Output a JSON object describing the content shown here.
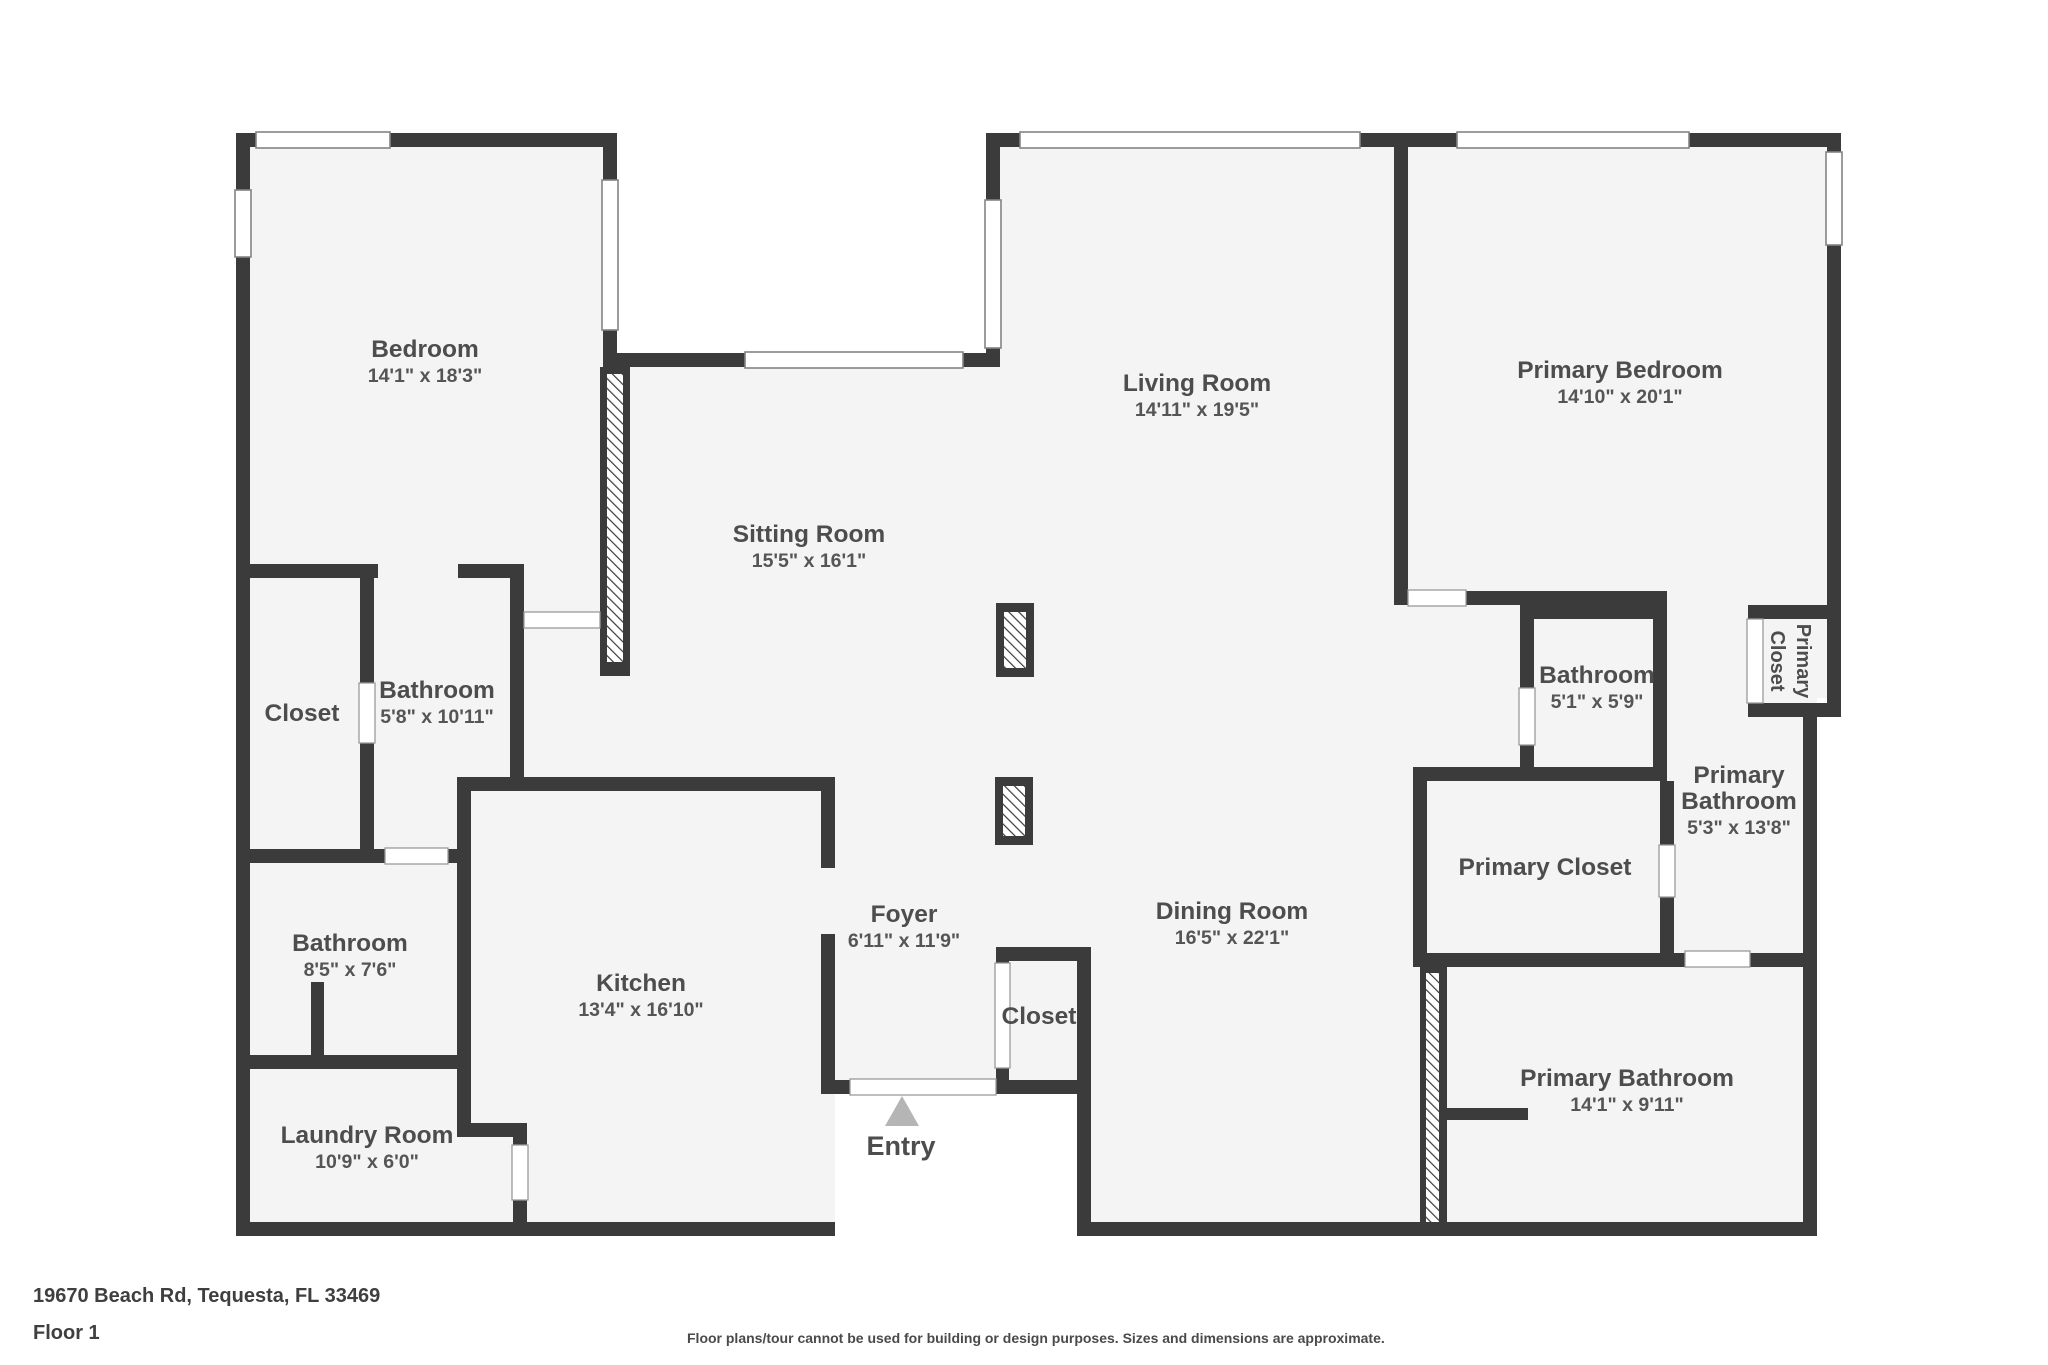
{
  "footer": {
    "address": "19670 Beach Rd, Tequesta, FL 33469",
    "floor": "Floor 1",
    "disclaimer": "Floor plans/tour cannot be used for building or design purposes. Sizes and dimensions are approximate."
  },
  "floorplan": {
    "colors": {
      "wall": "#3b3b3b",
      "floor": "#f4f4f4",
      "outside": "#ffffff",
      "opening_fill": "#ffffff",
      "window_stroke": "#848484",
      "door_stroke": "#9a9a9a",
      "label": "#4d4d4d",
      "dim": "#555555",
      "entry_marker": "#b5b5b5"
    },
    "floors": [
      [
        243,
        140,
        1591,
        1090
      ]
    ],
    "cutouts": [
      [
        617,
        98,
        370,
        257
      ],
      [
        835,
        1094,
        242,
        170
      ],
      [
        1817,
        698,
        45,
        560
      ]
    ],
    "hatches": [
      {
        "base": [
          600,
          367,
          30,
          309
        ],
        "inner": [
          607,
          374,
          16,
          288
        ]
      },
      {
        "base": [
          1420,
          965,
          27,
          271
        ],
        "inner": [
          1426,
          973,
          13,
          250
        ]
      },
      {
        "base": [
          996,
          603,
          38,
          74
        ],
        "inner": [
          1004,
          612,
          22,
          56
        ]
      },
      {
        "base": [
          995,
          777,
          38,
          68
        ],
        "inner": [
          1003,
          786,
          22,
          50
        ]
      }
    ],
    "walls": [
      [
        236,
        133,
        381,
        14
      ],
      [
        986,
        133,
        422,
        14
      ],
      [
        1394,
        133,
        447,
        14
      ],
      [
        603,
        353,
        397,
        14
      ],
      [
        236,
        564,
        288,
        14
      ],
      [
        236,
        849,
        235,
        14
      ],
      [
        457,
        777,
        378,
        14
      ],
      [
        236,
        1055,
        235,
        14
      ],
      [
        236,
        1222,
        599,
        14
      ],
      [
        457,
        1123,
        70,
        14
      ],
      [
        821,
        1080,
        189,
        14
      ],
      [
        996,
        947,
        95,
        14
      ],
      [
        1009,
        1080,
        82,
        14
      ],
      [
        1077,
        1222,
        740,
        14
      ],
      [
        1394,
        591,
        273,
        14
      ],
      [
        1520,
        605,
        147,
        14
      ],
      [
        1748,
        605,
        93,
        14
      ],
      [
        1748,
        703,
        93,
        14
      ],
      [
        1417,
        953,
        391,
        14
      ],
      [
        1413,
        767,
        254,
        14
      ],
      [
        1447,
        1108,
        81,
        12
      ],
      [
        236,
        133,
        14,
        1103
      ],
      [
        603,
        133,
        14,
        234
      ],
      [
        360,
        578,
        14,
        285
      ],
      [
        510,
        578,
        14,
        213
      ],
      [
        457,
        791,
        14,
        332
      ],
      [
        513,
        1137,
        14,
        99
      ],
      [
        821,
        791,
        14,
        303
      ],
      [
        996,
        947,
        13,
        147
      ],
      [
        1077,
        947,
        14,
        289
      ],
      [
        986,
        133,
        14,
        234
      ],
      [
        1394,
        133,
        14,
        472
      ],
      [
        1827,
        133,
        14,
        584
      ],
      [
        1803,
        703,
        14,
        533
      ],
      [
        1520,
        605,
        14,
        176
      ],
      [
        1653,
        605,
        14,
        176
      ],
      [
        1660,
        781,
        14,
        186
      ],
      [
        1413,
        767,
        14,
        200
      ],
      [
        311,
        982,
        13,
        73
      ]
    ],
    "gaps": [
      [
        378,
        563,
        80,
        16
      ],
      [
        820,
        868,
        16,
        66
      ]
    ],
    "windows": [
      [
        256,
        132,
        134,
        16
      ],
      [
        235,
        190,
        16,
        67
      ],
      [
        602,
        180,
        16,
        150
      ],
      [
        745,
        352,
        218,
        16
      ],
      [
        985,
        200,
        16,
        148
      ],
      [
        1020,
        132,
        340,
        16
      ],
      [
        1457,
        132,
        232,
        16
      ],
      [
        1826,
        152,
        16,
        93
      ]
    ],
    "doors": [
      [
        385,
        848,
        63,
        16
      ],
      [
        359,
        683,
        16,
        60
      ],
      [
        524,
        612,
        76,
        16
      ],
      [
        512,
        1145,
        16,
        55
      ],
      [
        850,
        1079,
        146,
        16
      ],
      [
        995,
        963,
        15,
        105
      ],
      [
        1408,
        590,
        58,
        16
      ],
      [
        1519,
        688,
        16,
        57
      ],
      [
        1659,
        845,
        16,
        52
      ],
      [
        1685,
        951,
        65,
        16
      ],
      [
        1747,
        619,
        16,
        84
      ]
    ],
    "entry_marker": {
      "points": [
        [
          902,
          1096
        ],
        [
          885,
          1126
        ],
        [
          919,
          1126
        ]
      ]
    },
    "labels": [
      {
        "lines": [
          "Bedroom"
        ],
        "dim": "14'1\" x 18'3\"",
        "x": 425,
        "y": 357
      },
      {
        "lines": [
          "Sitting Room"
        ],
        "dim": "15'5\" x 16'1\"",
        "x": 809,
        "y": 542
      },
      {
        "lines": [
          "Living Room"
        ],
        "dim": "14'11\" x 19'5\"",
        "x": 1197,
        "y": 391
      },
      {
        "lines": [
          "Primary Bedroom"
        ],
        "dim": "14'10\" x 20'1\"",
        "x": 1620,
        "y": 378
      },
      {
        "lines": [
          "Closet"
        ],
        "dim": null,
        "x": 302,
        "y": 721
      },
      {
        "lines": [
          "Bathroom"
        ],
        "dim": "5'8\" x 10'11\"",
        "x": 437,
        "y": 698
      },
      {
        "lines": [
          "Bathroom"
        ],
        "dim": "8'5\" x 7'6\"",
        "x": 350,
        "y": 951
      },
      {
        "lines": [
          "Laundry Room"
        ],
        "dim": "10'9\" x 6'0\"",
        "x": 367,
        "y": 1143
      },
      {
        "lines": [
          "Kitchen"
        ],
        "dim": "13'4\" x 16'10\"",
        "x": 641,
        "y": 991
      },
      {
        "lines": [
          "Foyer"
        ],
        "dim": "6'11\" x 11'9\"",
        "x": 904,
        "y": 922
      },
      {
        "lines": [
          "Closet"
        ],
        "dim": null,
        "x": 1039,
        "y": 1024
      },
      {
        "lines": [
          "Dining Room"
        ],
        "dim": "16'5\" x 22'1\"",
        "x": 1232,
        "y": 919
      },
      {
        "lines": [
          "Bathroom"
        ],
        "dim": "5'1\" x 5'9\"",
        "x": 1597,
        "y": 683
      },
      {
        "lines": [
          "Primary",
          "Bathroom"
        ],
        "dim": "5'3\" x 13'8\"",
        "x": 1739,
        "y": 783
      },
      {
        "lines": [
          "Primary Closet"
        ],
        "dim": null,
        "x": 1545,
        "y": 875
      },
      {
        "lines": [
          "Primary Bathroom"
        ],
        "dim": "14'1\" x 9'11\"",
        "x": 1627,
        "y": 1086
      },
      {
        "lines": [
          "Entry"
        ],
        "dim": null,
        "x": 901,
        "y": 1155,
        "size": 27
      },
      {
        "lines": [
          "Primary",
          "Closet"
        ],
        "dim": null,
        "x": 1797,
        "y": 661,
        "rot": 90,
        "size": 20
      }
    ]
  }
}
